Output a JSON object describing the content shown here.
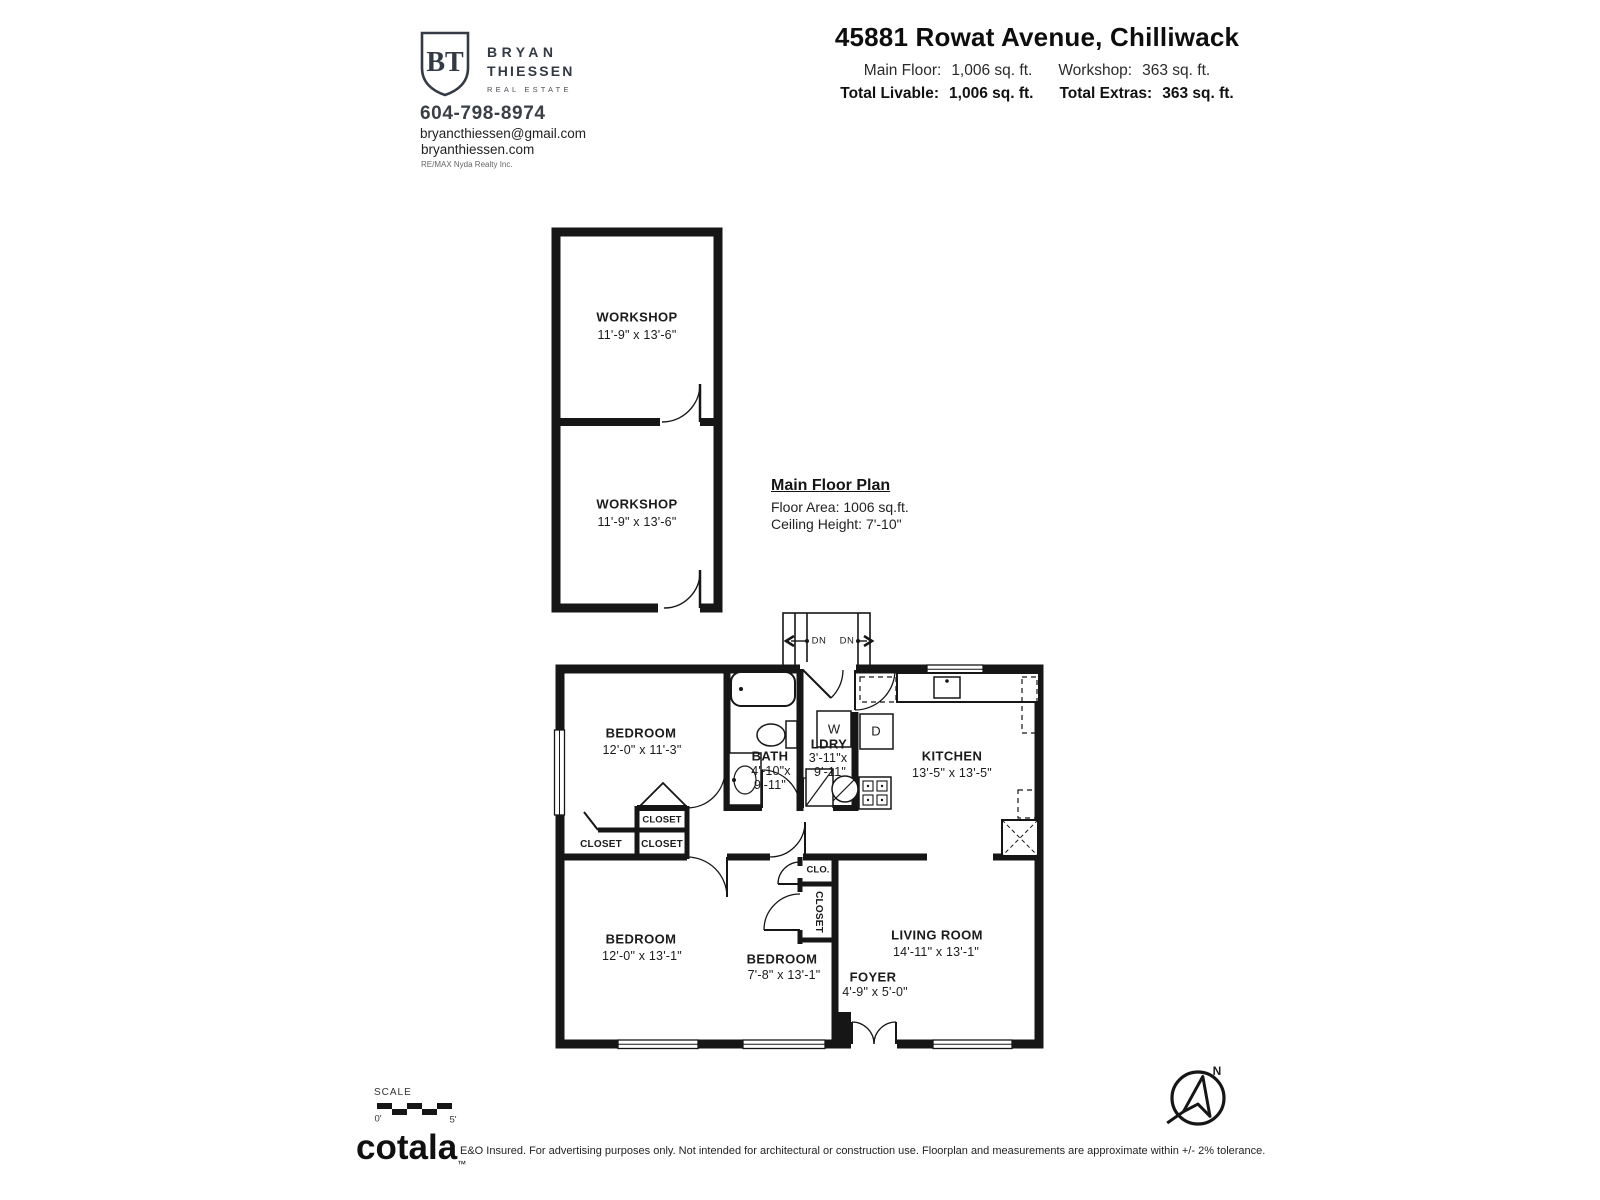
{
  "colors": {
    "wall": "#161616",
    "text": "#1b1b1b",
    "brand": "#333a45"
  },
  "header": {
    "brand": {
      "initials": "BT",
      "name_line1": "BRYAN",
      "name_line2": "THIESSEN",
      "tagline": "REAL ESTATE"
    },
    "phone": "604-798-8974",
    "email": "bryancthiessen@gmail.com",
    "website": "bryanthiessen.com",
    "brokerage": "RE/MAX Nyda Realty Inc.",
    "title": "45881 Rowat Avenue, Chilliwack",
    "stats": {
      "main_floor_label": "Main Floor:",
      "main_floor_value": "1,006 sq. ft.",
      "workshop_label": "Workshop:",
      "workshop_value": "363 sq. ft.",
      "total_livable_label": "Total Livable:",
      "total_livable_value": "1,006 sq. ft.",
      "total_extras_label": "Total Extras:",
      "total_extras_value": "363 sq. ft."
    }
  },
  "plan_note": {
    "title": "Main Floor Plan",
    "floor_area": "Floor Area: 1006 sq.ft.",
    "ceiling_height": "Ceiling Height: 7'-10\""
  },
  "rooms": {
    "workshop1": {
      "name": "WORKSHOP",
      "dims": "11'-9\" x 13'-6\""
    },
    "workshop2": {
      "name": "WORKSHOP",
      "dims": "11'-9\" x 13'-6\""
    },
    "bedroom1": {
      "name": "BEDROOM",
      "dims": "12'-0\" x 11'-3\""
    },
    "bath": {
      "name": "BATH",
      "dims_line1": "4'-10\"x",
      "dims_line2": "9'-11\""
    },
    "laundry": {
      "name": "LDRY",
      "dims_line1": "3'-11\"x",
      "dims_line2": "9'-11\""
    },
    "kitchen": {
      "name": "KITCHEN",
      "dims": "13'-5\" x 13'-5\""
    },
    "bedroom2": {
      "name": "BEDROOM",
      "dims": "12'-0\" x 13'-1\""
    },
    "bedroom3": {
      "name": "BEDROOM",
      "dims": "7'-8\" x 13'-1\""
    },
    "living_room": {
      "name": "LIVING ROOM",
      "dims": "14'-11\" x 13'-1\""
    },
    "foyer": {
      "name": "FOYER",
      "dims": "4'-9\" x 5'-0\""
    }
  },
  "plan_labels": {
    "closet": "CLOSET",
    "clo": "CLO.",
    "washer": "W",
    "dryer": "D",
    "down": "DN"
  },
  "footer": {
    "scale_label": "SCALE",
    "scale_start": "0'",
    "scale_end": "5'",
    "logo": "cotala",
    "logo_tm": "™",
    "disclaimer": "E&O Insured. For advertising purposes only. Not intended for architectural or construction use. Floorplan and measurements are approximate within +/- 2% tolerance.",
    "north": "N"
  }
}
